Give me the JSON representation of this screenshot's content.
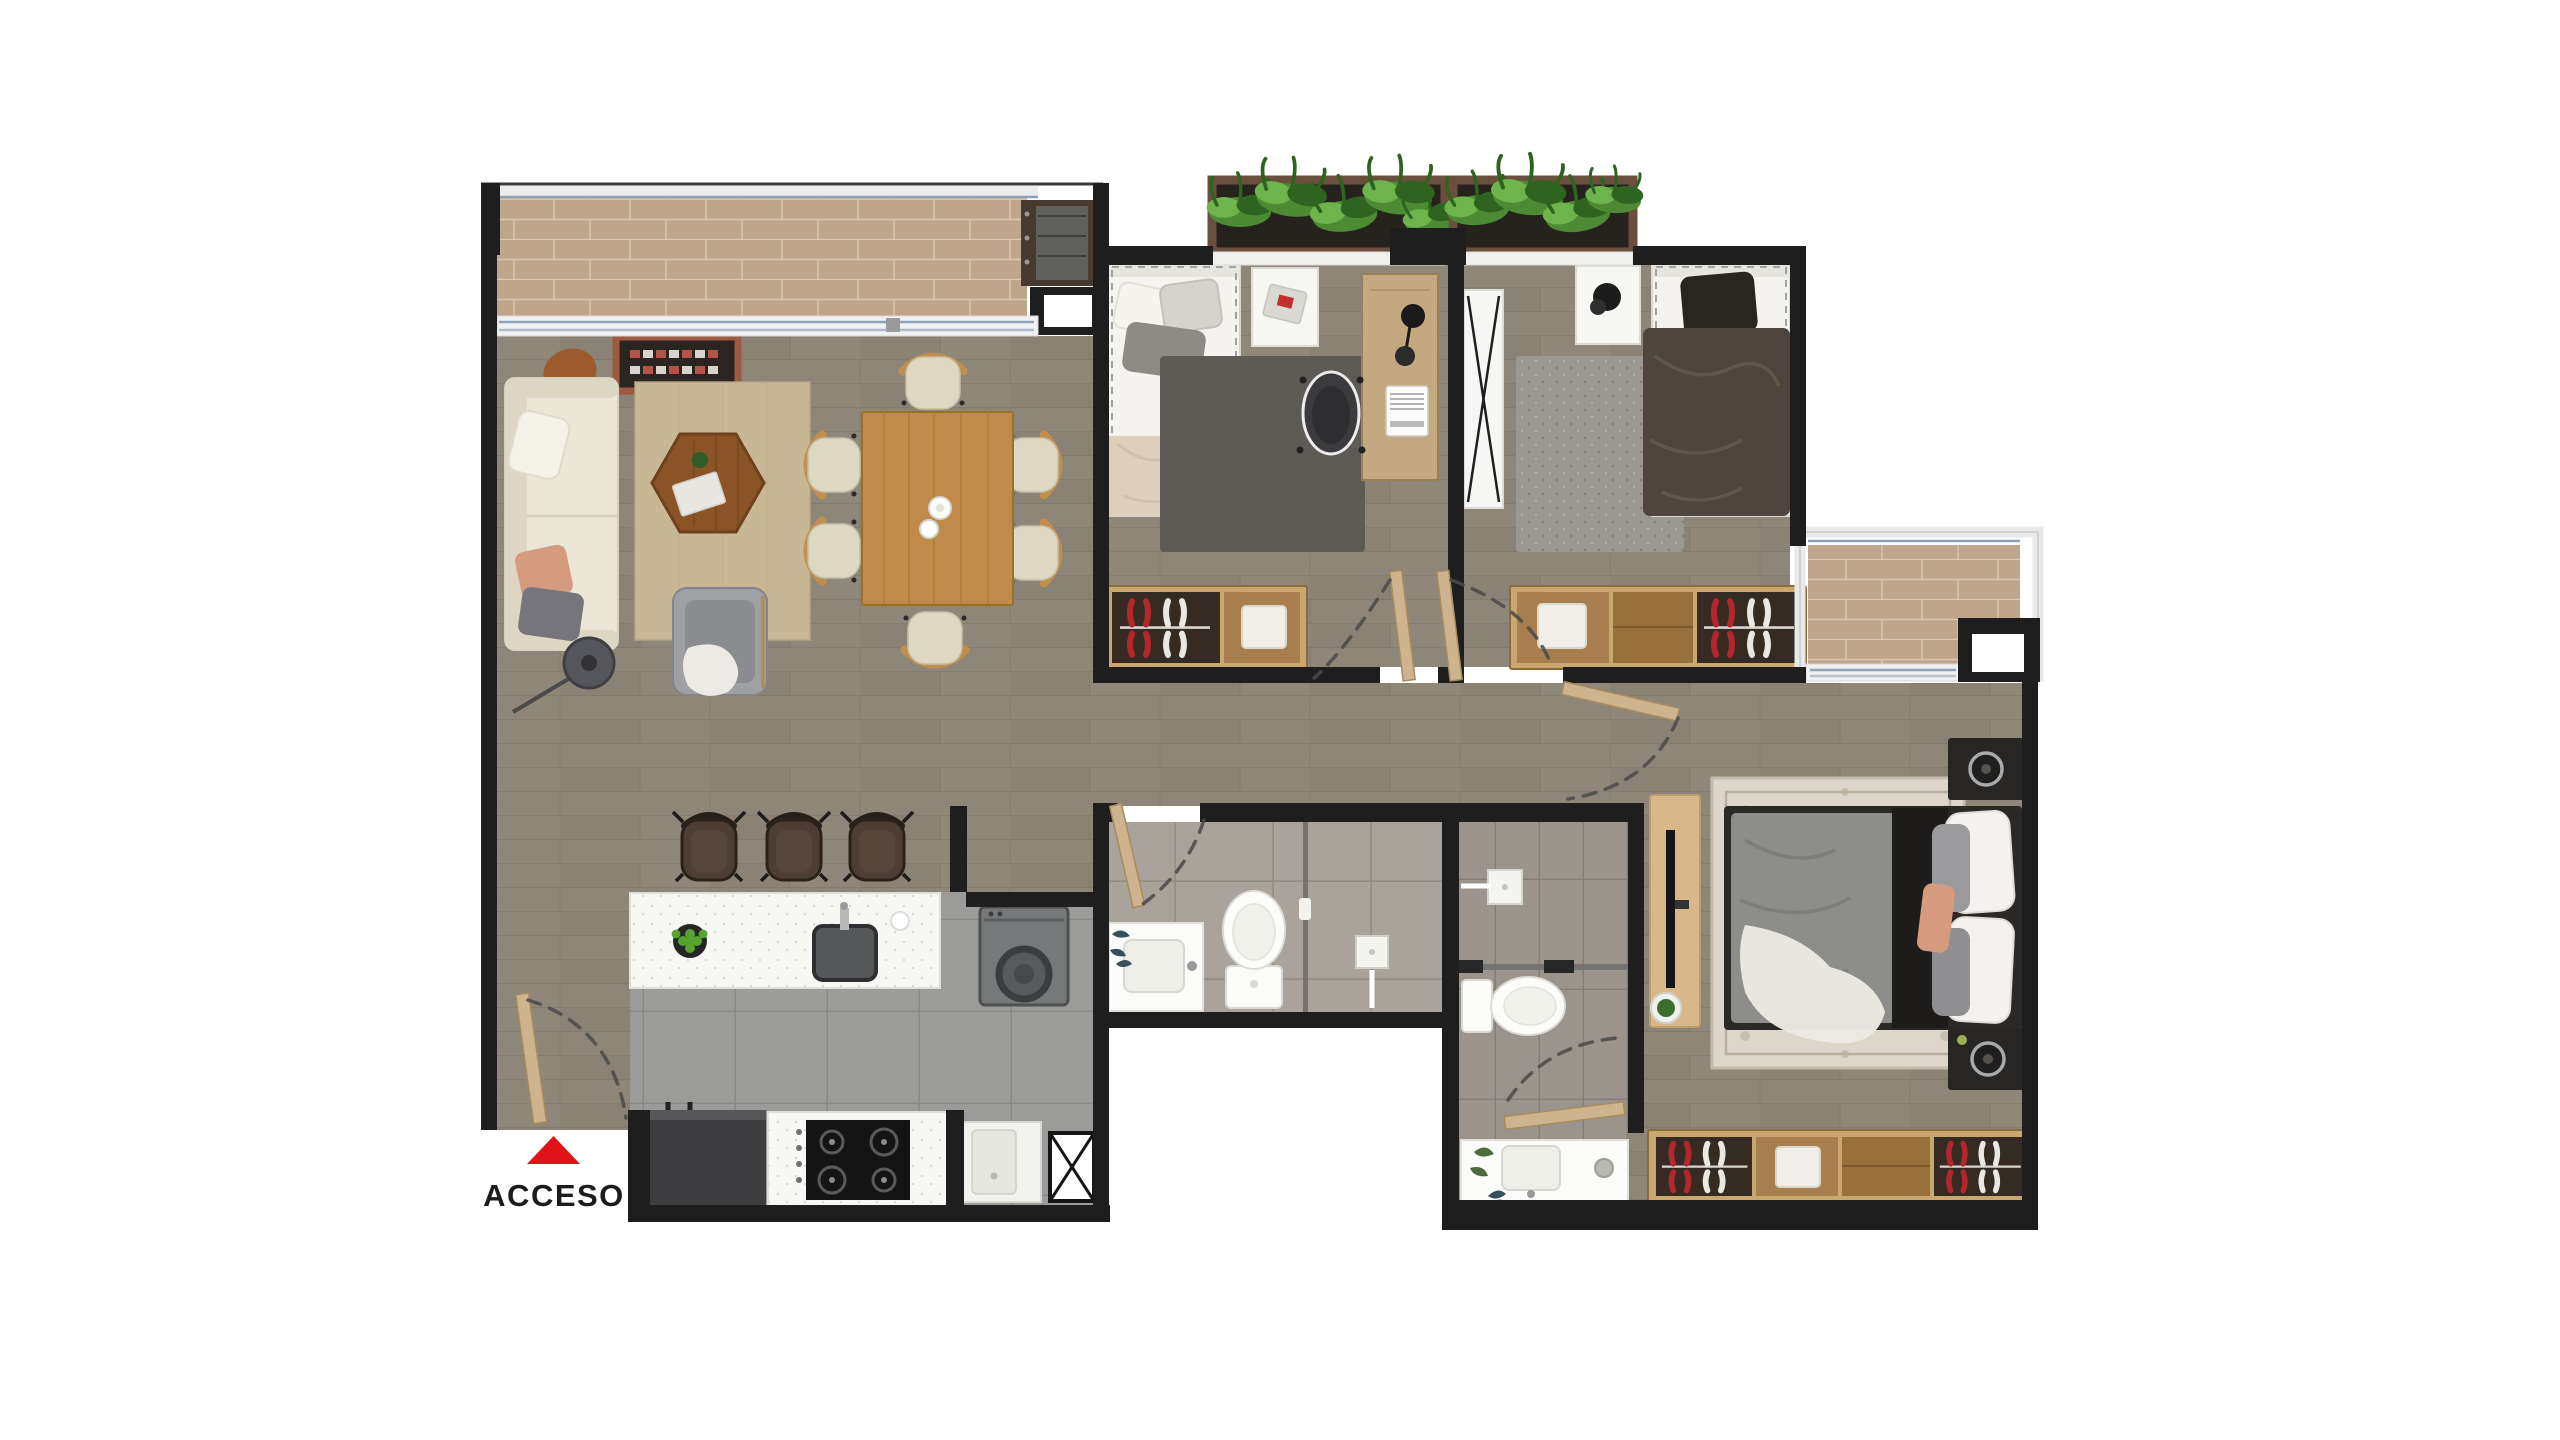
{
  "legend": {
    "access_label": "ACCESO",
    "access_arrow_icon": "red-triangle-up-icon"
  },
  "rooms": [
    "living-dining-room",
    "kitchen",
    "laundry-nook",
    "entry",
    "corridor",
    "bedroom-1",
    "bedroom-2",
    "master-bedroom",
    "bathroom-1",
    "master-bathroom",
    "living-balcony",
    "master-balcony",
    "planter-boxes",
    "service-shaft"
  ],
  "palette": {
    "wall": "#1e1e1e",
    "floorWood": "#8e8779",
    "floorWoodLine": "#776f61",
    "balconyTile": "#c0a58d",
    "balconyLine": "#d9c6b1",
    "kitchenTile": "#9b9b99",
    "kitchenLine": "#898987",
    "bathTile": "#a9a39c",
    "bathLine": "#948d84",
    "bath2Tile": "#9a948d",
    "bath2Line": "#857e76",
    "railing": "#ececec",
    "glassBlue": "#8fa3b8",
    "counter": "#f7f7f4",
    "counterDot": "#d7d7d2",
    "sofa": "#ebe6d8",
    "sofaShade": "#dcd6c3",
    "rugBeige": "#c7b795",
    "rugDark": "#5e5b56",
    "rugGray": "#9b9894",
    "rugOrnate": "#dcd7ca",
    "rugOrnateLine": "#b8af9d",
    "tableWood": "#c08b4a",
    "tableWoodDark": "#a8742f",
    "coffeeWood": "#8a5426",
    "chairCushion": "#ded7c2",
    "chairWood": "#c08e4d",
    "stool": "#4c3e35",
    "armGray": "#9fa0a3",
    "salmon": "#d69a7f",
    "pillowGray": "#8e8b86",
    "appliance": "#3e3e40",
    "washer": "#77787a",
    "hob": "#141414",
    "doorWood": "#cdb38e",
    "doorEdge": "#a98a5c",
    "dash": "#4a4a4a",
    "planterBox": "#6a4f3e",
    "soil": "#26221d",
    "plant": "#4c8b33",
    "plantDark": "#2f6320",
    "plantLight": "#6db44d",
    "closetFrame": "#c9a86f",
    "closetWood": "#a87e4e",
    "closetWoodDark": "#97703c",
    "closetDark": "#352b23",
    "clothesRed": "#b3262c",
    "clothesWhite": "#eae8e4",
    "duvet2": "#4e453e",
    "duvetMaster": "#8d8d8b",
    "bedWhite": "#f4f3ef",
    "frameDark": "#2b2927",
    "black": "#1d1c1b",
    "tvConsole": "#d8b88a",
    "slat": "#c8a87c",
    "red": "#e01418",
    "text": "#1c1c1c",
    "white": "#ffffff"
  }
}
